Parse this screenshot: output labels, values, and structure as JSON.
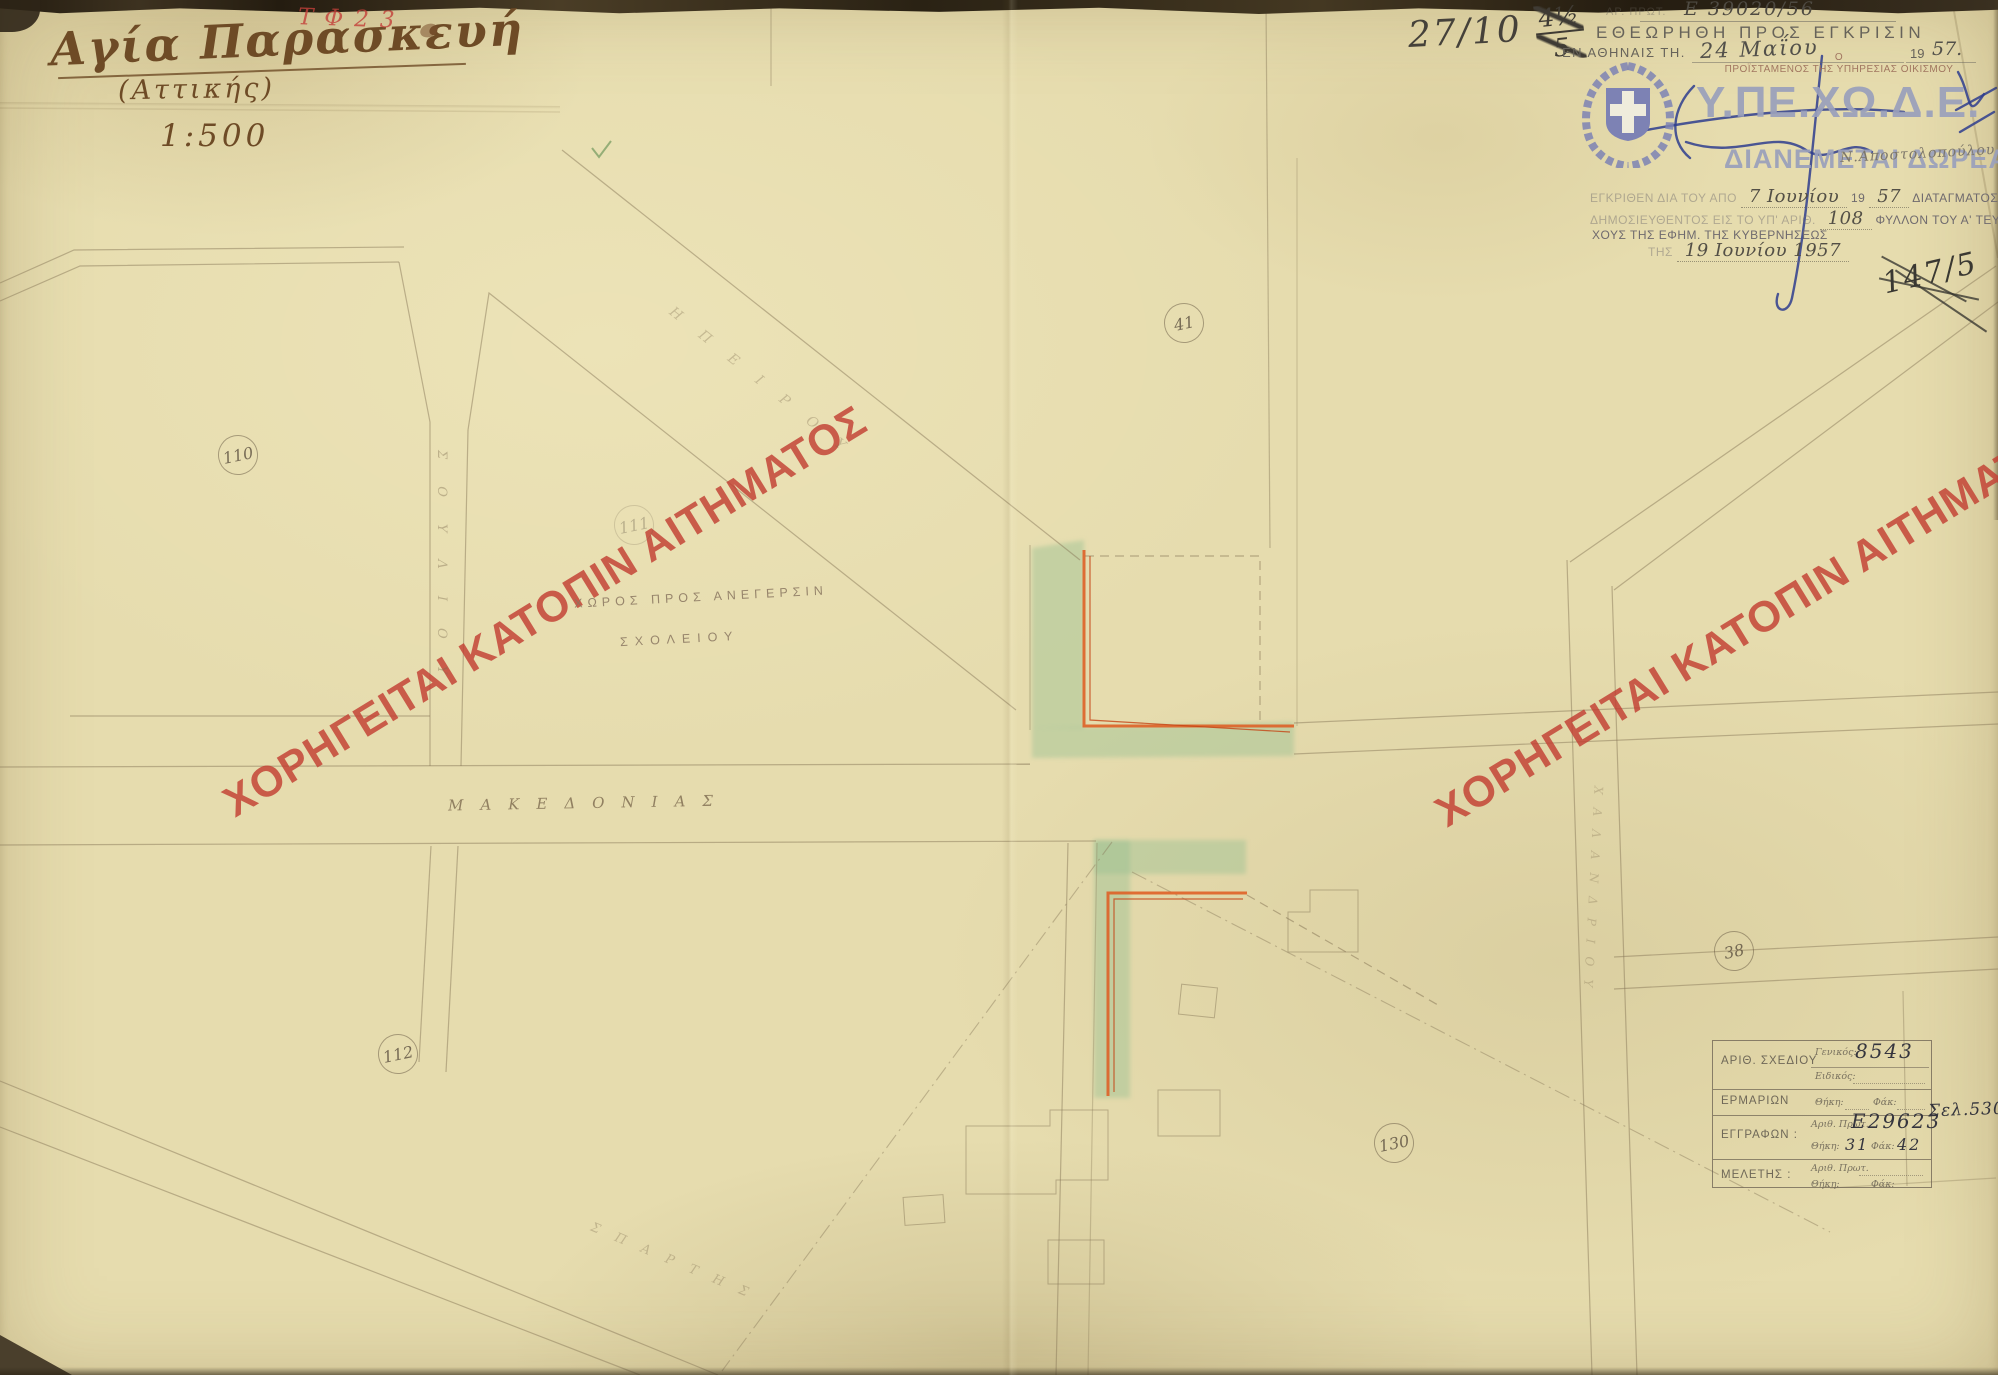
{
  "title_block": {
    "title": "Αγία Παρασκευή",
    "subtitle": "(Αττικής)",
    "scale": "1:500",
    "red_note": "ΤΦ23"
  },
  "annotations": {
    "pencil_ref": "27/10",
    "pencil_frac_num": "4½",
    "pencil_frac_den": "5",
    "crossed_ref": "147/5"
  },
  "approval_stamp": {
    "faded_label": "ΑΡ. ΠΡΩΤ.",
    "protocol": "Ε 39020/56",
    "line1": "ΕΘΕΩΡΗΘΗ ΠΡΟΣ ΕΓΚΡΙΣΙΝ",
    "place_prefix": "ΕΝ ΑΘΗΝΑΙΣ ΤΗ.",
    "date": "24 Μαΐου",
    "year_print": "19",
    "year_hand": "57."
  },
  "ministry_mark": {
    "chief_article": "Ο",
    "chief_title": "ΠΡΟΪΣΤΑΜΕΝΟΣ ΤΗΣ ΥΠΗΡΕΣΙΑΣ ΟΙΚΙΣΜΟΥ",
    "acronym": "Υ.ΠΕ.ΧΩ.Δ.Ε.",
    "free_note": "ΔΙΑΝΕΜΕΤΑΙ ΔΩΡΕΑΝ",
    "hand_name": "Ν.Αποστολοπούλου",
    "emblem_color": "#7d82b4",
    "text_color": "#9aa0bc"
  },
  "decree_stamp": {
    "l1a": "ΕΓΚΡΙΘΕΝ ΔΙΑ ΤΟΥ ΑΠΟ",
    "l1_date": "7 Ιουνίου",
    "l1b": "19",
    "l1_year": "57",
    "l1c": "ΔΙΑΤΑΓΜΑΤΟΣ",
    "l2a": "ΔΗΜΟΣΙΕΥΘΕΝΤΟΣ ΕΙΣ ΤΟ ΥΠ' ΑΡΙΘ.",
    "l2_num": "108",
    "l2b": "ΦΥΛΛΟΝ ΤΟΥ Α' ΤΕΥ-",
    "l3": "ΧΟΥΣ ΤΗΣ ΕΦΗΜ. ΤΗΣ ΚΥΒΕΡΝΗΣΕΩΣ",
    "l4a": "ΤΗΣ",
    "l4_date": "19 Ιουνίου 1957"
  },
  "watermark": {
    "text": "ΧΟΡΗΓΕΙΤΑΙ ΚΑΤΟΠΙΝ ΑΙΤΗΜΑΤΟΣ",
    "color": "#c23e32"
  },
  "map": {
    "street_main": "ΜΑΚΕΔΟΝΙΑΣ",
    "street_diag_nw": "ΗΠΕΙΡΟΥ",
    "street_vert_w": "ΣΟΥΛΙΟΥ",
    "street_diag_sw": "ΣΠΑΡΤΗΣ",
    "street_vert_e": "ΧΑΛΑΝΔΡΙΟΥ",
    "site_note1": "ΧΩΡΟΣ ΠΡΟΣ ΑΝΕΓΕΡΣΙΝ",
    "site_note2": "ΣΧΟΛΕΙΟΥ",
    "blocks": {
      "b110": "110",
      "b111": "111",
      "b112": "112",
      "b41": "41",
      "b38": "38",
      "b130": "130"
    },
    "green_area_color": "#9ac092",
    "alignment_line_color": "#df5a20"
  },
  "drawing_table": {
    "r1_label": "ΑΡΙΘ. ΣΧΕΔΙΟΥ",
    "r1_f1": "Γενικός:",
    "r1_v1": "8543",
    "r1_f2": "Ειδικός:",
    "r2_label": "ΕΡΜΑΡΙΩΝ",
    "f_thiki": "Θήκη:",
    "f_fak": "Φάκ:",
    "r3_label": "ΕΓΓΡΑΦΩΝ :",
    "f_prot": "Αριθ. Πρωτ.",
    "r3_v1": "Ε29623",
    "r3_extra": "Σελ.530",
    "r3_thiki": "31",
    "r3_fak": "42",
    "r4_label": "ΜΕΛΕΤΗΣ :"
  }
}
